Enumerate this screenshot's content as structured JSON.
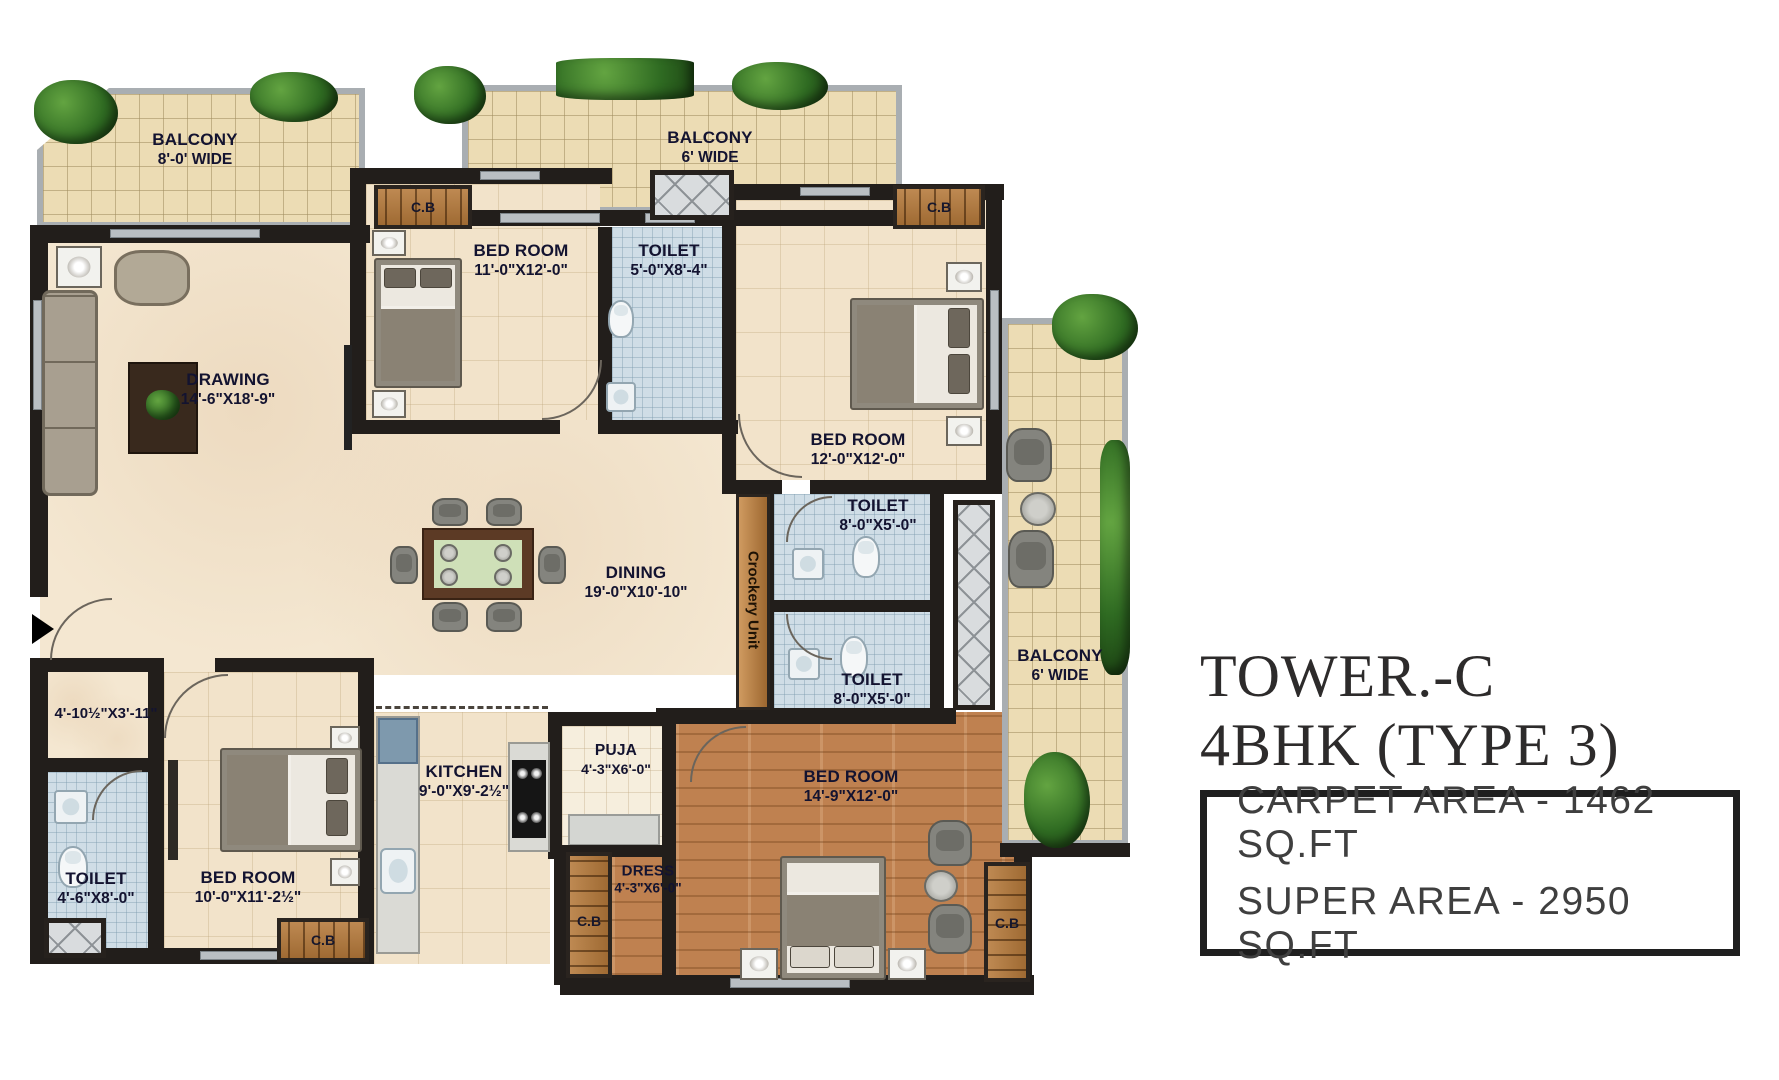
{
  "title": {
    "line1": "TOWER.-C",
    "line2": "4BHK (TYPE 3)"
  },
  "area_box": {
    "carpet_area": "CARPET AREA - 1462 SQ.FT",
    "super_area": "SUPER AREA - 2950 SQ.FT"
  },
  "labels": {
    "cb": "C.B",
    "crockery_unit": "Crockery Unit"
  },
  "rooms": [
    {
      "id": "balcony-top-left",
      "name": "BALCONY",
      "dims": "8'-0' WIDE"
    },
    {
      "id": "balcony-top",
      "name": "BALCONY",
      "dims": "6' WIDE"
    },
    {
      "id": "bedroom-1",
      "name": "BED ROOM",
      "dims": "11'-0\"X12'-0\""
    },
    {
      "id": "toilet-1",
      "name": "TOILET",
      "dims": "5'-0\"X8'-4\""
    },
    {
      "id": "bedroom-2",
      "name": "BED ROOM",
      "dims": "12'-0\"X12'-0\""
    },
    {
      "id": "drawing",
      "name": "DRAWING",
      "dims": "14'-6\"X18'-9\""
    },
    {
      "id": "dining",
      "name": "DINING",
      "dims": "19'-0\"X10'-10\""
    },
    {
      "id": "toilet-2",
      "name": "TOILET",
      "dims": "8'-0\"X5'-0\""
    },
    {
      "id": "toilet-3",
      "name": "TOILET",
      "dims": "8'-0\"X5'-0\""
    },
    {
      "id": "balcony-right",
      "name": "BALCONY",
      "dims": "6' WIDE"
    },
    {
      "id": "lobby",
      "name": "",
      "dims": "4'-10½\"X3'-11\""
    },
    {
      "id": "toilet-4",
      "name": "TOILET",
      "dims": "4'-6\"X8'-0\""
    },
    {
      "id": "bedroom-3",
      "name": "BED ROOM",
      "dims": "10'-0\"X11'-2½\""
    },
    {
      "id": "kitchen",
      "name": "KITCHEN",
      "dims": "9'-0\"X9'-2½\""
    },
    {
      "id": "puja",
      "name": "PUJA",
      "dims": "4'-3\"X6'-0\""
    },
    {
      "id": "dress",
      "name": "DRESS",
      "dims": "4'-3\"X6'-0\""
    },
    {
      "id": "bedroom-4",
      "name": "BED ROOM",
      "dims": "14'-9\"X12'-0\""
    }
  ],
  "colors": {
    "wall": "#221e1b",
    "balcony_floor": "#ecdcb4",
    "marble_floor": "#f4e7d1",
    "toilet_floor": "#cfdde6",
    "wood_floor": "#bf8150",
    "cupboard": "#b5793a",
    "label_text": "#131330",
    "title_text": "#2d2b2b"
  }
}
